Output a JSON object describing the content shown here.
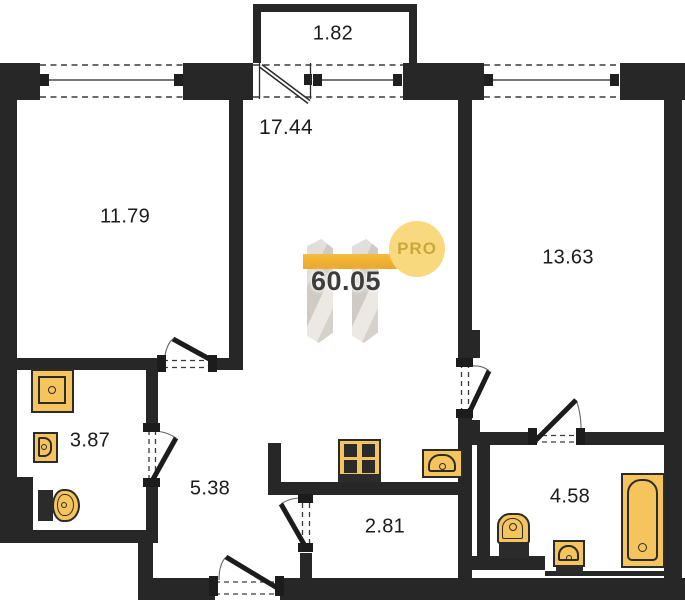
{
  "title": "Apartment floor plan 60.05 m²",
  "watermark": {
    "total_area": "60.05",
    "badge": "PRO"
  },
  "rooms": [
    {
      "name": "balcony",
      "area": "1.82"
    },
    {
      "name": "living-kitchen",
      "area": "17.44"
    },
    {
      "name": "room-left",
      "area": "11.79"
    },
    {
      "name": "room-right",
      "area": "13.63"
    },
    {
      "name": "bathroom-left",
      "area": "3.87"
    },
    {
      "name": "hallway",
      "area": "5.38"
    },
    {
      "name": "wardrobe",
      "area": "2.81"
    },
    {
      "name": "bathroom-right",
      "area": "4.58"
    }
  ],
  "fixtures": [
    "washing-machine",
    "small-sink",
    "toilet",
    "stove",
    "kitchen-sink",
    "toilet",
    "small-sink",
    "bathtub"
  ],
  "colors": {
    "wall": "#272727",
    "fixture_fill": "#f6c45c",
    "logo_circle": "#f9d97e",
    "logo_bar": "#f0b13a",
    "logo_text": "#c9a83c",
    "area_text": "#3d3d3d",
    "label_text": "#1b1b1b"
  }
}
